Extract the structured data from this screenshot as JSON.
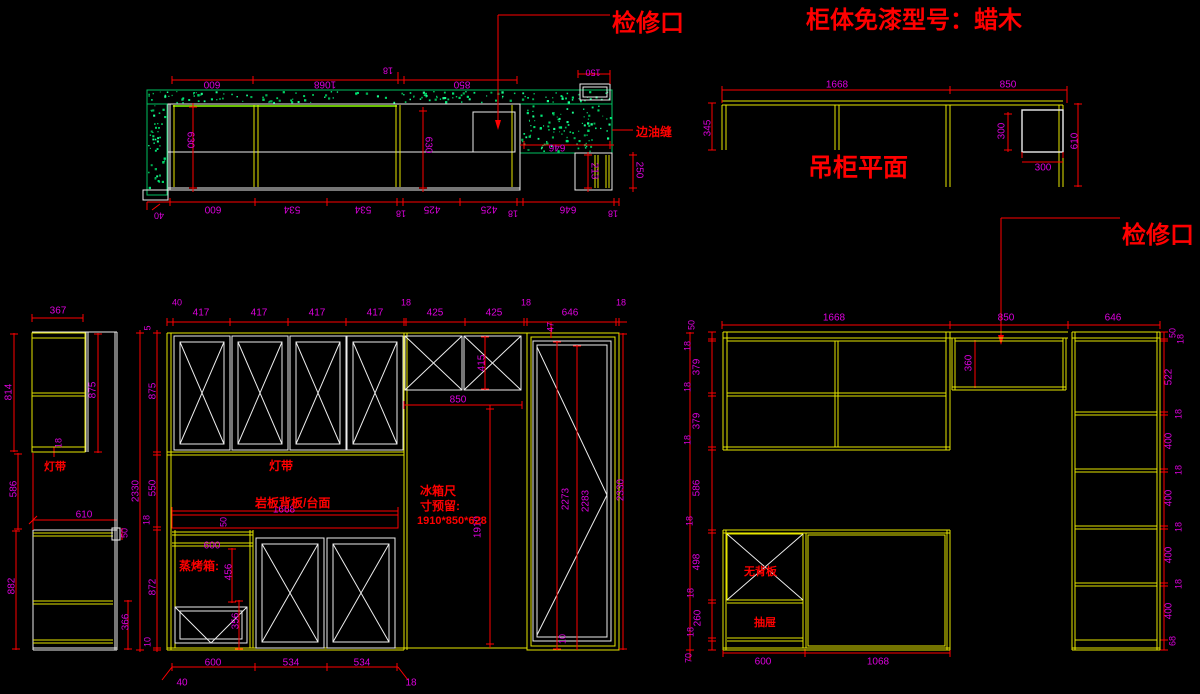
{
  "colors": {
    "background": "#000000",
    "dimension": "#dd00dd",
    "annotation": "#ff0000",
    "carcass": "#e6e600",
    "panel": "#ededed",
    "stone": "#00c060"
  },
  "titles": [
    {
      "name": "access-port-label-1",
      "t": "检修口",
      "x": 612,
      "y": 31,
      "s": 24
    },
    {
      "name": "cabinet-model-label",
      "t": "柜体免漆型号：蜡木",
      "x": 806,
      "y": 28,
      "s": 24
    },
    {
      "name": "hanging-plan-title",
      "t": "吊柜平面",
      "x": 808,
      "y": 176,
      "s": 25
    },
    {
      "name": "access-port-label-2",
      "t": "检修口",
      "x": 1122,
      "y": 243,
      "s": 24
    }
  ],
  "notes": [
    {
      "name": "edge-seam-note",
      "t": "边油缝",
      "x": 636,
      "y": 136,
      "s": 12
    },
    {
      "name": "light-strip-note-side",
      "t": "灯带",
      "x": 44,
      "y": 470,
      "s": 11
    },
    {
      "name": "light-strip-note-main",
      "t": "灯带",
      "x": 269,
      "y": 470,
      "s": 12
    },
    {
      "name": "slab-backboard-note",
      "t": "岩板背板/台面",
      "x": 255,
      "y": 507,
      "s": 12
    },
    {
      "name": "fridge-note-line1",
      "t": "冰箱尺",
      "x": 420,
      "y": 495,
      "s": 12
    },
    {
      "name": "fridge-note-line2",
      "t": "寸预留:",
      "x": 420,
      "y": 510,
      "s": 12
    },
    {
      "name": "fridge-note-line3",
      "t": "1910*850*628",
      "x": 417,
      "y": 524,
      "s": 11
    },
    {
      "name": "steam-oven-note",
      "t": "蒸烤箱:",
      "x": 179,
      "y": 570,
      "s": 12
    },
    {
      "name": "no-backboard-note",
      "t": "无背板",
      "x": 744,
      "y": 575,
      "s": 11
    },
    {
      "name": "drawer-note",
      "t": "抽屉",
      "x": 754,
      "y": 626,
      "s": 11
    }
  ],
  "dims": [
    {
      "t": "600",
      "x": 212,
      "y": 84,
      "r": 180
    },
    {
      "t": "1068",
      "x": 325,
      "y": 84,
      "r": 180
    },
    {
      "t": "18",
      "x": 388,
      "y": 70,
      "r": 180,
      "s": 9
    },
    {
      "t": "850",
      "x": 462,
      "y": 84,
      "r": 180
    },
    {
      "t": "150",
      "x": 593,
      "y": 72,
      "r": 180,
      "s": 9
    },
    {
      "t": "630",
      "x": 190,
      "y": 140,
      "r": 90
    },
    {
      "t": "630",
      "x": 428,
      "y": 145,
      "r": 90
    },
    {
      "t": "646",
      "x": 557,
      "y": 147,
      "r": 180
    },
    {
      "t": "213",
      "x": 594,
      "y": 171,
      "r": 90
    },
    {
      "t": "250",
      "x": 639,
      "y": 170,
      "r": 90
    },
    {
      "t": "40",
      "x": 159,
      "y": 215,
      "r": 180,
      "s": 9
    },
    {
      "t": "600",
      "x": 213,
      "y": 209,
      "r": 180
    },
    {
      "t": "534",
      "x": 292,
      "y": 209,
      "r": 180
    },
    {
      "t": "534",
      "x": 363,
      "y": 209,
      "r": 180
    },
    {
      "t": "18",
      "x": 401,
      "y": 213,
      "r": 180,
      "s": 9
    },
    {
      "t": "425",
      "x": 432,
      "y": 209,
      "r": 180
    },
    {
      "t": "425",
      "x": 489,
      "y": 209,
      "r": 180
    },
    {
      "t": "18",
      "x": 513,
      "y": 213,
      "r": 180,
      "s": 9
    },
    {
      "t": "646",
      "x": 568,
      "y": 209,
      "r": 180
    },
    {
      "t": "18",
      "x": 613,
      "y": 213,
      "r": 180,
      "s": 9
    },
    {
      "t": "1668",
      "x": 837,
      "y": 85,
      "r": 0
    },
    {
      "t": "850",
      "x": 1008,
      "y": 85,
      "r": 0
    },
    {
      "t": "345",
      "x": 708,
      "y": 128,
      "r": -90
    },
    {
      "t": "300",
      "x": 1002,
      "y": 131,
      "r": -90
    },
    {
      "t": "300",
      "x": 1043,
      "y": 168,
      "r": 0
    },
    {
      "t": "610",
      "x": 1075,
      "y": 141,
      "r": -90
    },
    {
      "t": "367",
      "x": 58,
      "y": 311,
      "r": 0
    },
    {
      "t": "814",
      "x": 9,
      "y": 392,
      "r": -90
    },
    {
      "t": "875",
      "x": 93,
      "y": 390,
      "r": -90
    },
    {
      "t": "18",
      "x": 59,
      "y": 443,
      "r": -90,
      "s": 9
    },
    {
      "t": "586",
      "x": 14,
      "y": 489,
      "r": -90
    },
    {
      "t": "610",
      "x": 84,
      "y": 515,
      "r": 0
    },
    {
      "t": "50",
      "x": 125,
      "y": 533,
      "r": -90,
      "s": 9
    },
    {
      "t": "882",
      "x": 12,
      "y": 586,
      "r": -90
    },
    {
      "t": "366",
      "x": 126,
      "y": 622,
      "r": -90
    },
    {
      "t": "5",
      "x": 148,
      "y": 328,
      "r": -90,
      "s": 9
    },
    {
      "t": "875",
      "x": 153,
      "y": 391,
      "r": -90
    },
    {
      "t": "2330",
      "x": 136,
      "y": 491,
      "r": -90
    },
    {
      "t": "550",
      "x": 153,
      "y": 488,
      "r": -90
    },
    {
      "t": "18",
      "x": 147,
      "y": 520,
      "r": -90,
      "s": 9
    },
    {
      "t": "872",
      "x": 153,
      "y": 587,
      "r": -90
    },
    {
      "t": "10",
      "x": 148,
      "y": 642,
      "r": -90,
      "s": 9
    },
    {
      "t": "40",
      "x": 177,
      "y": 303,
      "r": 0,
      "s": 9
    },
    {
      "t": "417",
      "x": 201,
      "y": 313,
      "r": 0
    },
    {
      "t": "417",
      "x": 259,
      "y": 313,
      "r": 0
    },
    {
      "t": "417",
      "x": 317,
      "y": 313,
      "r": 0
    },
    {
      "t": "417",
      "x": 375,
      "y": 313,
      "r": 0
    },
    {
      "t": "18",
      "x": 406,
      "y": 303,
      "r": 0,
      "s": 9
    },
    {
      "t": "425",
      "x": 435,
      "y": 313,
      "r": 0
    },
    {
      "t": "425",
      "x": 494,
      "y": 313,
      "r": 0
    },
    {
      "t": "18",
      "x": 526,
      "y": 303,
      "r": 0,
      "s": 9
    },
    {
      "t": "646",
      "x": 570,
      "y": 313,
      "r": 0
    },
    {
      "t": "18",
      "x": 621,
      "y": 303,
      "r": 0,
      "s": 9
    },
    {
      "t": "415",
      "x": 482,
      "y": 363,
      "r": -90
    },
    {
      "t": "47",
      "x": 551,
      "y": 327,
      "r": -90,
      "s": 9
    },
    {
      "t": "850",
      "x": 458,
      "y": 400,
      "r": 0
    },
    {
      "t": "1910",
      "x": 478,
      "y": 527,
      "r": -90
    },
    {
      "t": "2273",
      "x": 566,
      "y": 499,
      "r": -90
    },
    {
      "t": "2283",
      "x": 586,
      "y": 501,
      "r": -90
    },
    {
      "t": "2330",
      "x": 621,
      "y": 490,
      "r": -90
    },
    {
      "t": "10",
      "x": 563,
      "y": 639,
      "r": -90,
      "s": 9
    },
    {
      "t": "1668",
      "x": 284,
      "y": 510,
      "r": 0
    },
    {
      "t": "50",
      "x": 224,
      "y": 522,
      "r": -90,
      "s": 9
    },
    {
      "t": "600",
      "x": 212,
      "y": 546,
      "r": 0
    },
    {
      "t": "456",
      "x": 229,
      "y": 572,
      "r": -90
    },
    {
      "t": "356",
      "x": 236,
      "y": 621,
      "r": -90
    },
    {
      "t": "600",
      "x": 213,
      "y": 663,
      "r": 0
    },
    {
      "t": "534",
      "x": 291,
      "y": 663,
      "r": 0
    },
    {
      "t": "534",
      "x": 362,
      "y": 663,
      "r": 0
    },
    {
      "t": "40",
      "x": 182,
      "y": 683,
      "r": 0
    },
    {
      "t": "18",
      "x": 411,
      "y": 683,
      "r": 0
    },
    {
      "t": "1668",
      "x": 834,
      "y": 318,
      "r": 0
    },
    {
      "t": "850",
      "x": 1006,
      "y": 318,
      "r": 0
    },
    {
      "t": "646",
      "x": 1113,
      "y": 318,
      "r": 0
    },
    {
      "t": "50",
      "x": 692,
      "y": 325,
      "r": -90,
      "s": 9
    },
    {
      "t": "18",
      "x": 688,
      "y": 346,
      "r": -90,
      "s": 9
    },
    {
      "t": "379",
      "x": 697,
      "y": 367,
      "r": -90
    },
    {
      "t": "18",
      "x": 688,
      "y": 387,
      "r": -90,
      "s": 9
    },
    {
      "t": "379",
      "x": 697,
      "y": 421,
      "r": -90
    },
    {
      "t": "18",
      "x": 688,
      "y": 440,
      "r": -90,
      "s": 9
    },
    {
      "t": "586",
      "x": 697,
      "y": 488,
      "r": -90
    },
    {
      "t": "18",
      "x": 690,
      "y": 521,
      "r": -90,
      "s": 9
    },
    {
      "t": "498",
      "x": 697,
      "y": 562,
      "r": -90
    },
    {
      "t": "18",
      "x": 691,
      "y": 593,
      "r": -90,
      "s": 9
    },
    {
      "t": "260",
      "x": 698,
      "y": 618,
      "r": -90
    },
    {
      "t": "18",
      "x": 691,
      "y": 632,
      "r": -90,
      "s": 9
    },
    {
      "t": "70",
      "x": 689,
      "y": 658,
      "r": -90,
      "s": 9
    },
    {
      "t": "360",
      "x": 969,
      "y": 363,
      "r": -90
    },
    {
      "t": "50",
      "x": 1173,
      "y": 333,
      "r": -90,
      "s": 9
    },
    {
      "t": "18",
      "x": 1181,
      "y": 339,
      "r": -90,
      "s": 9
    },
    {
      "t": "522",
      "x": 1169,
      "y": 377,
      "r": -90
    },
    {
      "t": "18",
      "x": 1179,
      "y": 414,
      "r": -90,
      "s": 9
    },
    {
      "t": "400",
      "x": 1169,
      "y": 441,
      "r": -90
    },
    {
      "t": "18",
      "x": 1179,
      "y": 470,
      "r": -90,
      "s": 9
    },
    {
      "t": "400",
      "x": 1169,
      "y": 498,
      "r": -90
    },
    {
      "t": "18",
      "x": 1179,
      "y": 527,
      "r": -90,
      "s": 9
    },
    {
      "t": "400",
      "x": 1169,
      "y": 555,
      "r": -90
    },
    {
      "t": "18",
      "x": 1179,
      "y": 584,
      "r": -90,
      "s": 9
    },
    {
      "t": "400",
      "x": 1169,
      "y": 611,
      "r": -90
    },
    {
      "t": "68",
      "x": 1173,
      "y": 641,
      "r": -90,
      "s": 9
    },
    {
      "t": "600",
      "x": 763,
      "y": 662,
      "r": 0
    },
    {
      "t": "1068",
      "x": 878,
      "y": 662,
      "r": 0
    }
  ]
}
